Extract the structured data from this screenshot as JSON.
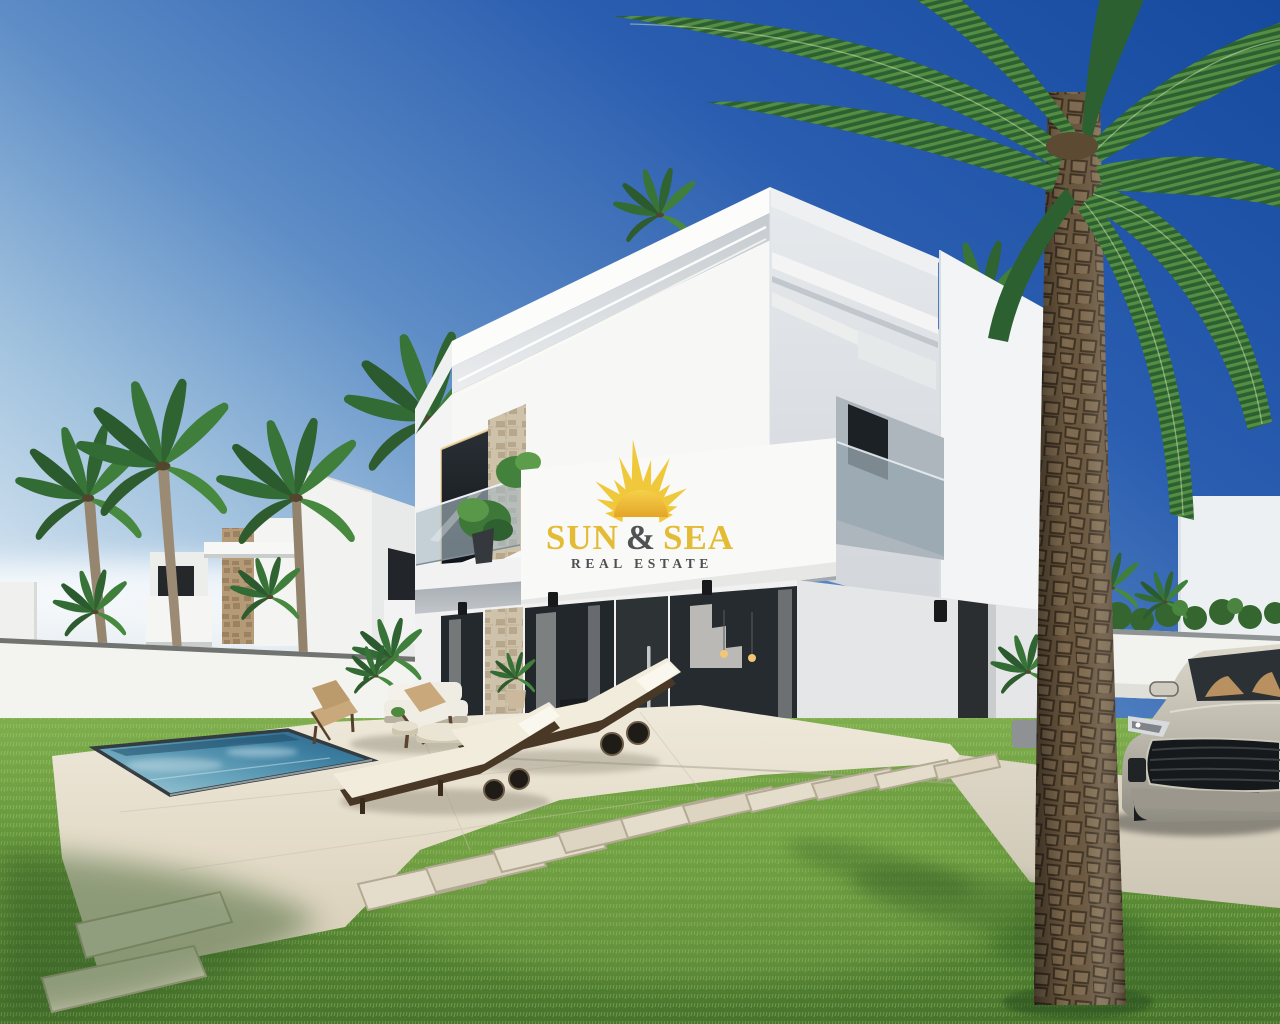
{
  "logo": {
    "word1": "SUN",
    "amp": "&",
    "word2": "SEA",
    "subtitle": "REAL ESTATE",
    "sun_color": "#f0c735",
    "sun_disc_color": "#e8ab26",
    "text_color": "#e3b92e",
    "amp_color": "#4b4c50",
    "subtitle_color": "#494a4e"
  },
  "palette": {
    "sky_top": "#154a9f",
    "sky_horizon": "#eaf2f7",
    "villa_white": "#f7f7f5",
    "villa_shade": "#d8dce0",
    "window_dark": "#20262a",
    "glass_balustrade": "#9fb2bd",
    "stone_clad": "#cfc2ab",
    "pool_deep": "#2a6187",
    "pool_light": "#a6cdd9",
    "paving": "#e7e0d0",
    "grass": "#6f9c3f",
    "palm_green": "#3f7d3c",
    "trunk_brown": "#6a573f",
    "car_silver": "#c9c4b8",
    "cushion_cream": "#f2ecdc",
    "wood_dark": "#4a3826"
  }
}
